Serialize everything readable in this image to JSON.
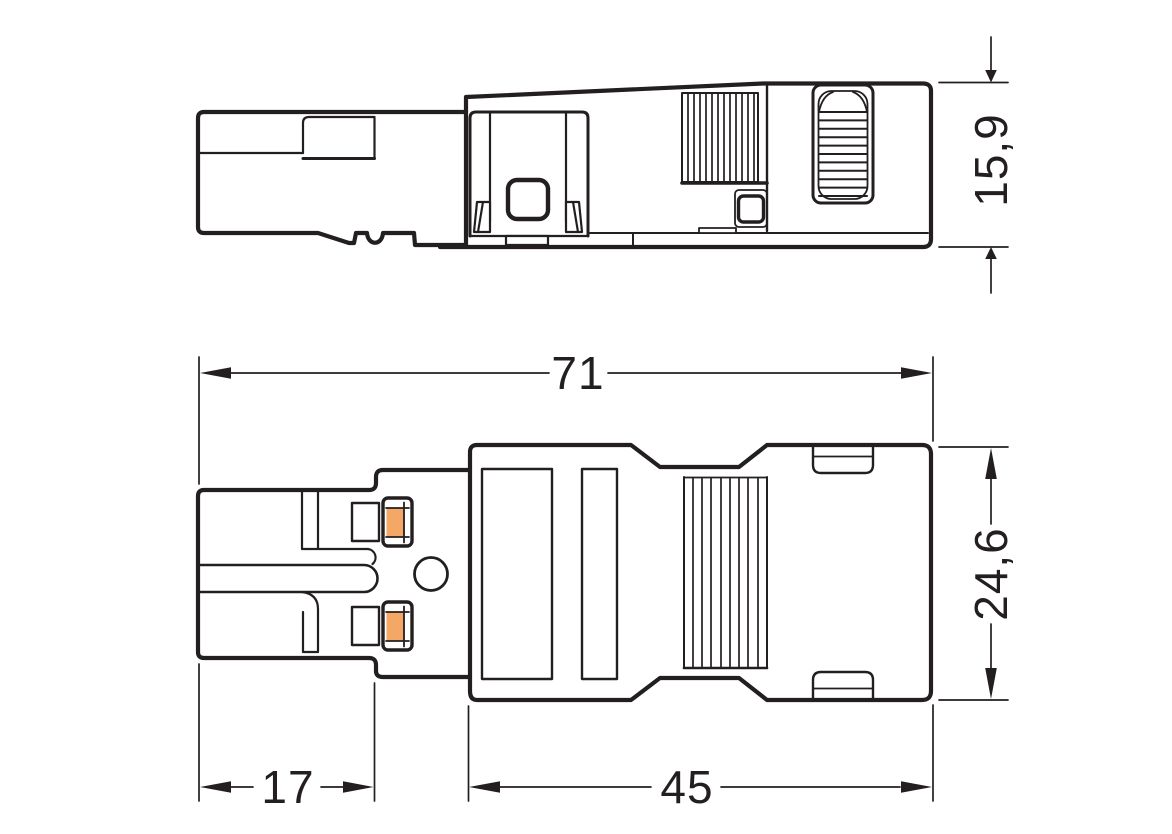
{
  "drawing": {
    "type": "technical-dimensional-drawing",
    "subject": "2-pole connector plug, two orthographic views",
    "colors": {
      "line": "#231f20",
      "contact_orange": "#F5A766",
      "background": "#ffffff"
    },
    "views": {
      "side_view": {
        "label": "side view"
      },
      "plan_view": {
        "label": "plan view"
      }
    },
    "dimensions": {
      "height": {
        "label": "15,9"
      },
      "overall_length": {
        "label": "71"
      },
      "width": {
        "label": "24,6"
      },
      "front_length": {
        "label": "17"
      },
      "body_length": {
        "label": "45"
      }
    }
  }
}
